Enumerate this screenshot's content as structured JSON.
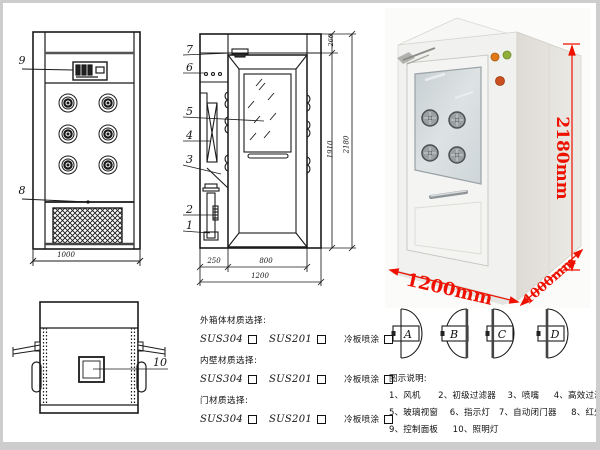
{
  "front_view": {
    "callout_9": "9",
    "callout_8": "8",
    "dim_width": "1000"
  },
  "side_view": {
    "callout_7": "7",
    "callout_6": "6",
    "callout_5": "5",
    "callout_4": "4",
    "callout_3": "3",
    "callout_2": "2",
    "callout_1": "1",
    "dim_top": "260",
    "dim_door": "1910",
    "dim_total": "2180",
    "dim_front": "250",
    "dim_depth": "800",
    "dim_overall": "1200"
  },
  "top_view": {
    "callout_10": "10"
  },
  "photo": {
    "dim_height": "2180mm",
    "dim_width": "1200mm",
    "dim_depth": "1000mm"
  },
  "materials": {
    "sections": [
      {
        "label": "外箱体材质选择:",
        "options": [
          "SUS304",
          "SUS201",
          "冷板喷涂"
        ]
      },
      {
        "label": "内壁材质选择:",
        "options": [
          "SUS304",
          "SUS201",
          "冷板喷涂"
        ]
      },
      {
        "label": "门材质选择:",
        "options": [
          "SUS304",
          "SUS201",
          "冷板喷涂"
        ]
      }
    ]
  },
  "door_configs": {
    "a": "A",
    "b": "B",
    "c": "C",
    "d": "D"
  },
  "legend": {
    "title": "图示说明:",
    "lines": [
      "1、风机      2、初级过滤器    3、喷嘴     4、高效过滤器",
      "5、玻璃视窗    6、指示灯   7、自动闭门器     8、红外线感应器",
      "9、控制面板     10、照明灯"
    ]
  },
  "colors": {
    "dimension_red": "#ee1100",
    "line_black": "#1a1a1a"
  }
}
